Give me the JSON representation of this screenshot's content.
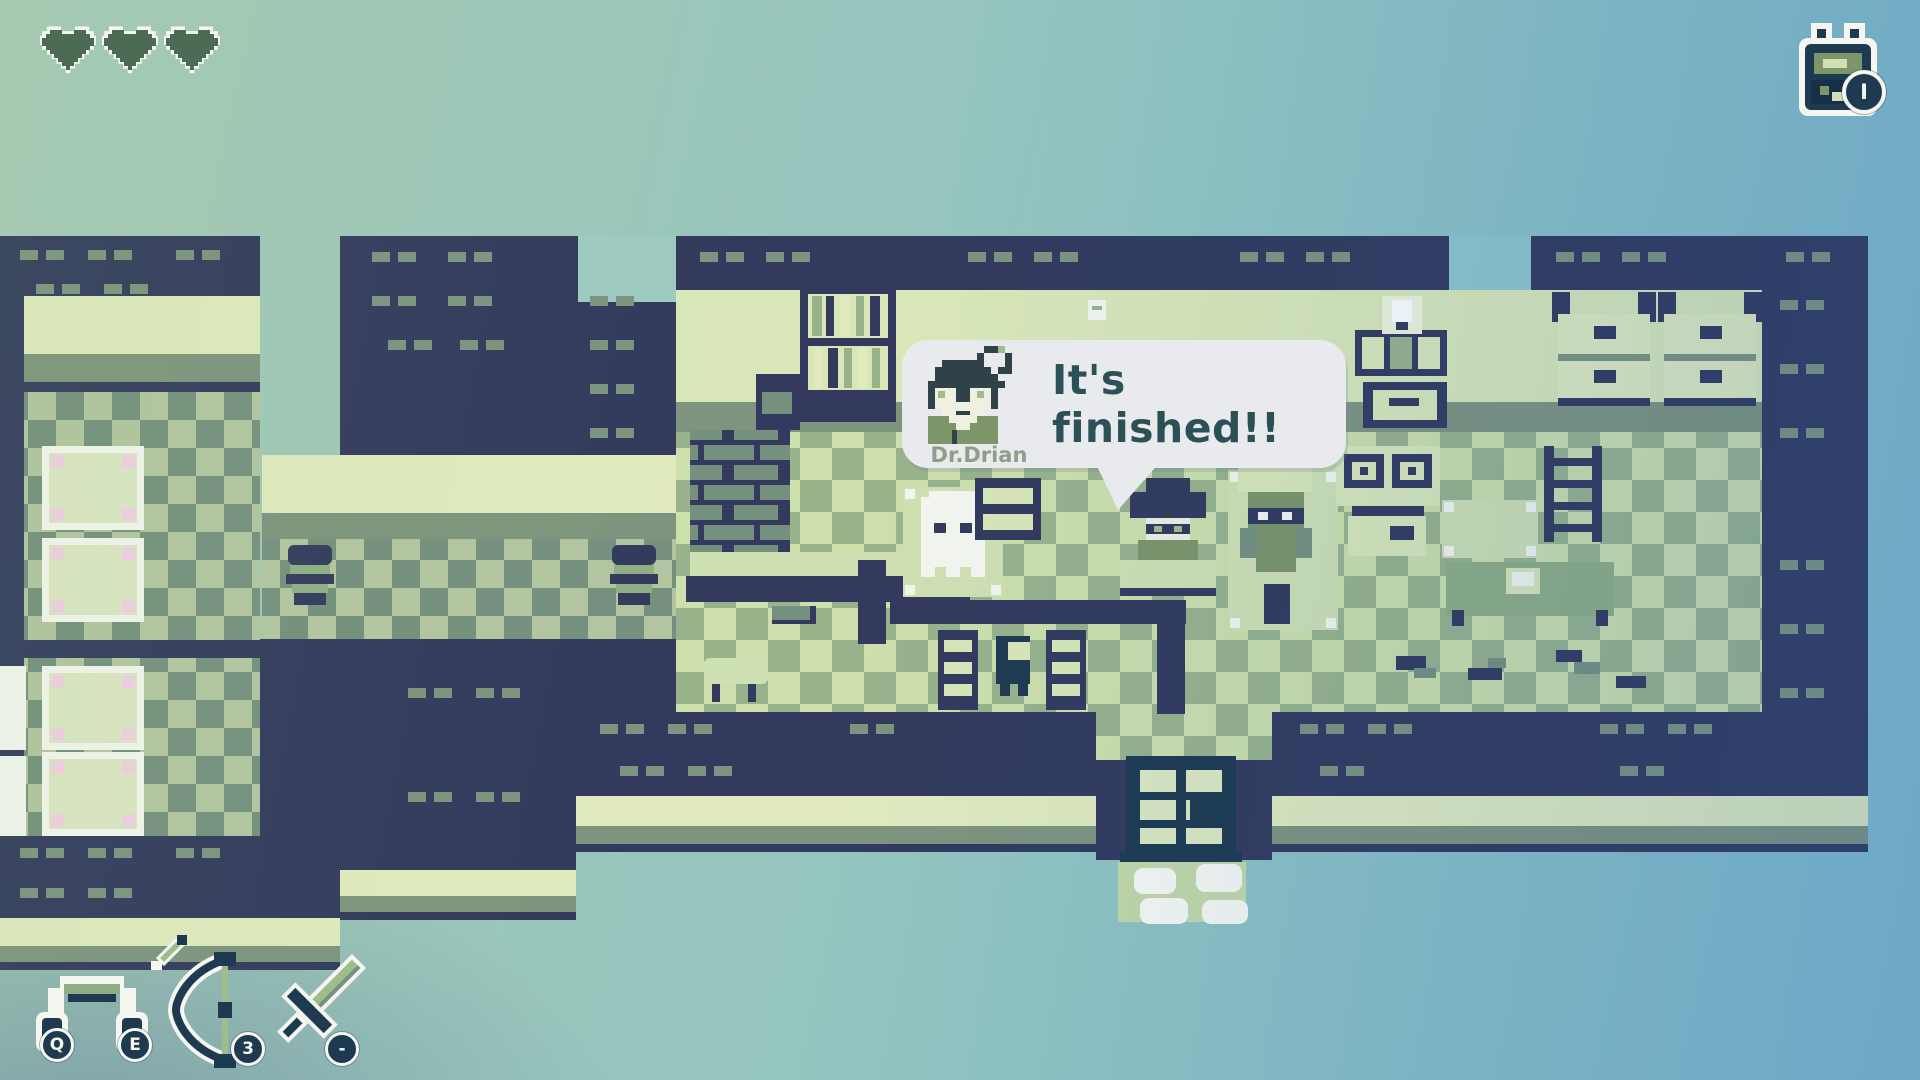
{
  "hud": {
    "health": {
      "label": "hearts",
      "count": 3
    },
    "inventory": {
      "hotkey_label": "I",
      "icon": "backpack-icon"
    },
    "equipment": [
      {
        "item": "headphones",
        "hotkeys": [
          "Q",
          "E"
        ]
      },
      {
        "item": "bow-and-arrow",
        "hotkeys": [
          "3"
        ]
      },
      {
        "item": "sword",
        "hotkeys": [
          "-"
        ]
      }
    ]
  },
  "dialogue": {
    "speaker": "Dr.Drian",
    "text": "It's finished!!"
  },
  "scene": {
    "name": "laboratory-interior",
    "landmarks": [
      "bed-room",
      "corridor",
      "main-lab",
      "bookshelf",
      "brick-wall",
      "armchair",
      "ghost",
      "dr-drian-at-desk",
      "plant-robot",
      "stove-burners",
      "monitor",
      "dresser-drawers",
      "ladder",
      "desk-with-paper",
      "benches",
      "sheep-table",
      "door",
      "smoke-clouds",
      "debris-plants"
    ]
  },
  "palette": {
    "wall": "#333a5d",
    "deep": "#1e3a50",
    "vent": "#7d937f",
    "cream": "#e0eabe",
    "strip": "#7e947e",
    "chkA1": "#b3c5a0",
    "chkA2": "#75907f",
    "chkB1": "#cddfab",
    "chkB2": "#98b28c",
    "pale": "#d9e7b8",
    "floorpale": "#cfe0b2",
    "white": "#f4f6ef",
    "pink": "#f2cfe2",
    "heart": "#4b6b54",
    "bubble": "#e9eaed",
    "ink": "#2b5157",
    "speaker": "#8d9e8a",
    "pDark": "#2e4247",
    "pGreen": "#7d9569",
    "pFace": "#eef0e2",
    "green2": "#8fae85",
    "blade": "#9fbd8a",
    "mat": "#c3d8a8"
  }
}
